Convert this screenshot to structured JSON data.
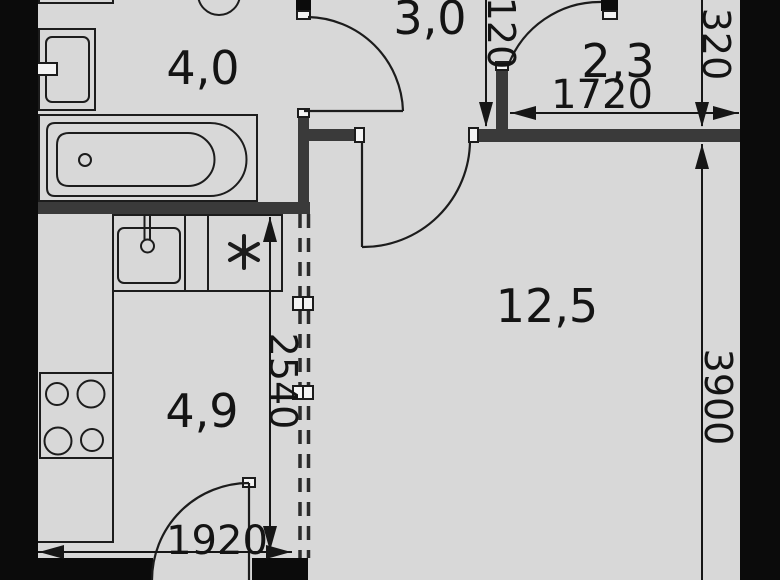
{
  "plan": {
    "type": "apartment-floor-plan",
    "rooms": {
      "bathroom": {
        "label": "4,0"
      },
      "hallway": {
        "label": "3,0"
      },
      "closet": {
        "label": "2,3"
      },
      "living": {
        "label": "12,5"
      },
      "kitchen": {
        "label": "4,9"
      }
    },
    "dimensions": {
      "d120": {
        "label": "120"
      },
      "d1720": {
        "label": "1720"
      },
      "d320": {
        "label": "320"
      },
      "d3900": {
        "label": "3900"
      },
      "d2540": {
        "label": "2540"
      },
      "d1920": {
        "label": "1920"
      }
    },
    "colors": {
      "floor": "#d8d8d8",
      "wall_interior": "#3a3a3a",
      "wall_exterior": "#0b0b0b",
      "line": "#1c1c1c",
      "cap": "#f4f4f4"
    }
  }
}
